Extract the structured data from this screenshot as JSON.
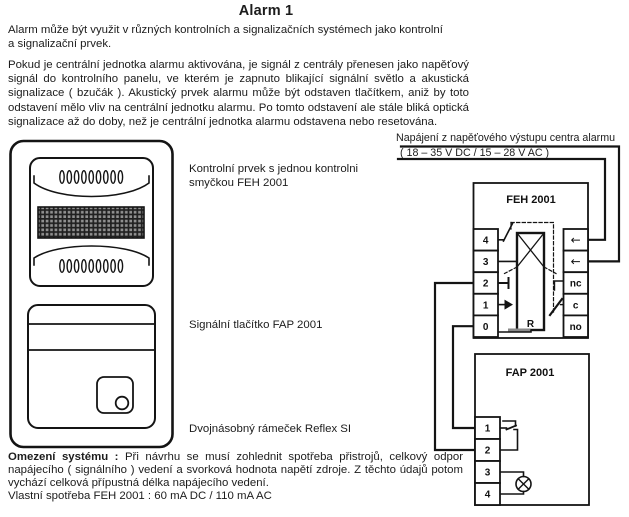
{
  "title": "Alarm 1",
  "intro_lines": [
    "Alarm může být využit v různých kontrolních a signalizačních systémech jako kontrolní",
    "a signalizační prvek."
  ],
  "body_lines": [
    "Pokud je centrální jednotka alarmu aktivována, je signál z centrály přenesen jako napěťový",
    "signál do kontrolního panelu, ve kterém je zapnuto blikající signální světlo a akustická",
    "signalizace ( bzučák ). Akustický prvek alarmu může být odstaven tlačítkem, aniž by toto",
    "odstavení mělo vliv na centrální jednotku alarmu.  Po tomto odstavení ale stále bliká optická",
    "signalizace až do doby, než je centrální jednotka alarmu odstavena nebo resetována."
  ],
  "device_labels": {
    "control_line1": "Kontrolní prvek s jednou kontrolni",
    "control_line2": "smyčkou FEH 2001",
    "button": "Signální tlačítko FAP 2001",
    "frame": "Dvojnásobný rámeček Reflex SI"
  },
  "wiring": {
    "power_caption": "Napájení z napěťového výstupu centra alarmu",
    "power_range": "( 18 – 35 V DC  /  15 – 28 V AC )",
    "feh": {
      "title": "FEH 2001",
      "left_terminals": [
        "4",
        "3",
        "2",
        "1",
        "0"
      ],
      "input_arrow_icon": "←",
      "contact_labels": [
        "nc",
        "c",
        "no"
      ],
      "relay_label": "R"
    },
    "fap": {
      "title": "FAP 2001",
      "terminals": [
        "1",
        "2",
        "3",
        "4"
      ]
    }
  },
  "footer": {
    "lead": "Omezení systému :",
    "line1_rest": "Při návrhu se musí zohlednit spotřeba přistrojů, celkový odpor",
    "line2": "napájecího ( signálního ) vedení a svorková hodnota napětí zdroje. Z těchto údajů potom",
    "line3": "vychází celková přípustná délka napájecího vedení.",
    "line4": "Vlastní spotřeba FEH 2001 : 60 mA DC / 110 mA AC"
  }
}
